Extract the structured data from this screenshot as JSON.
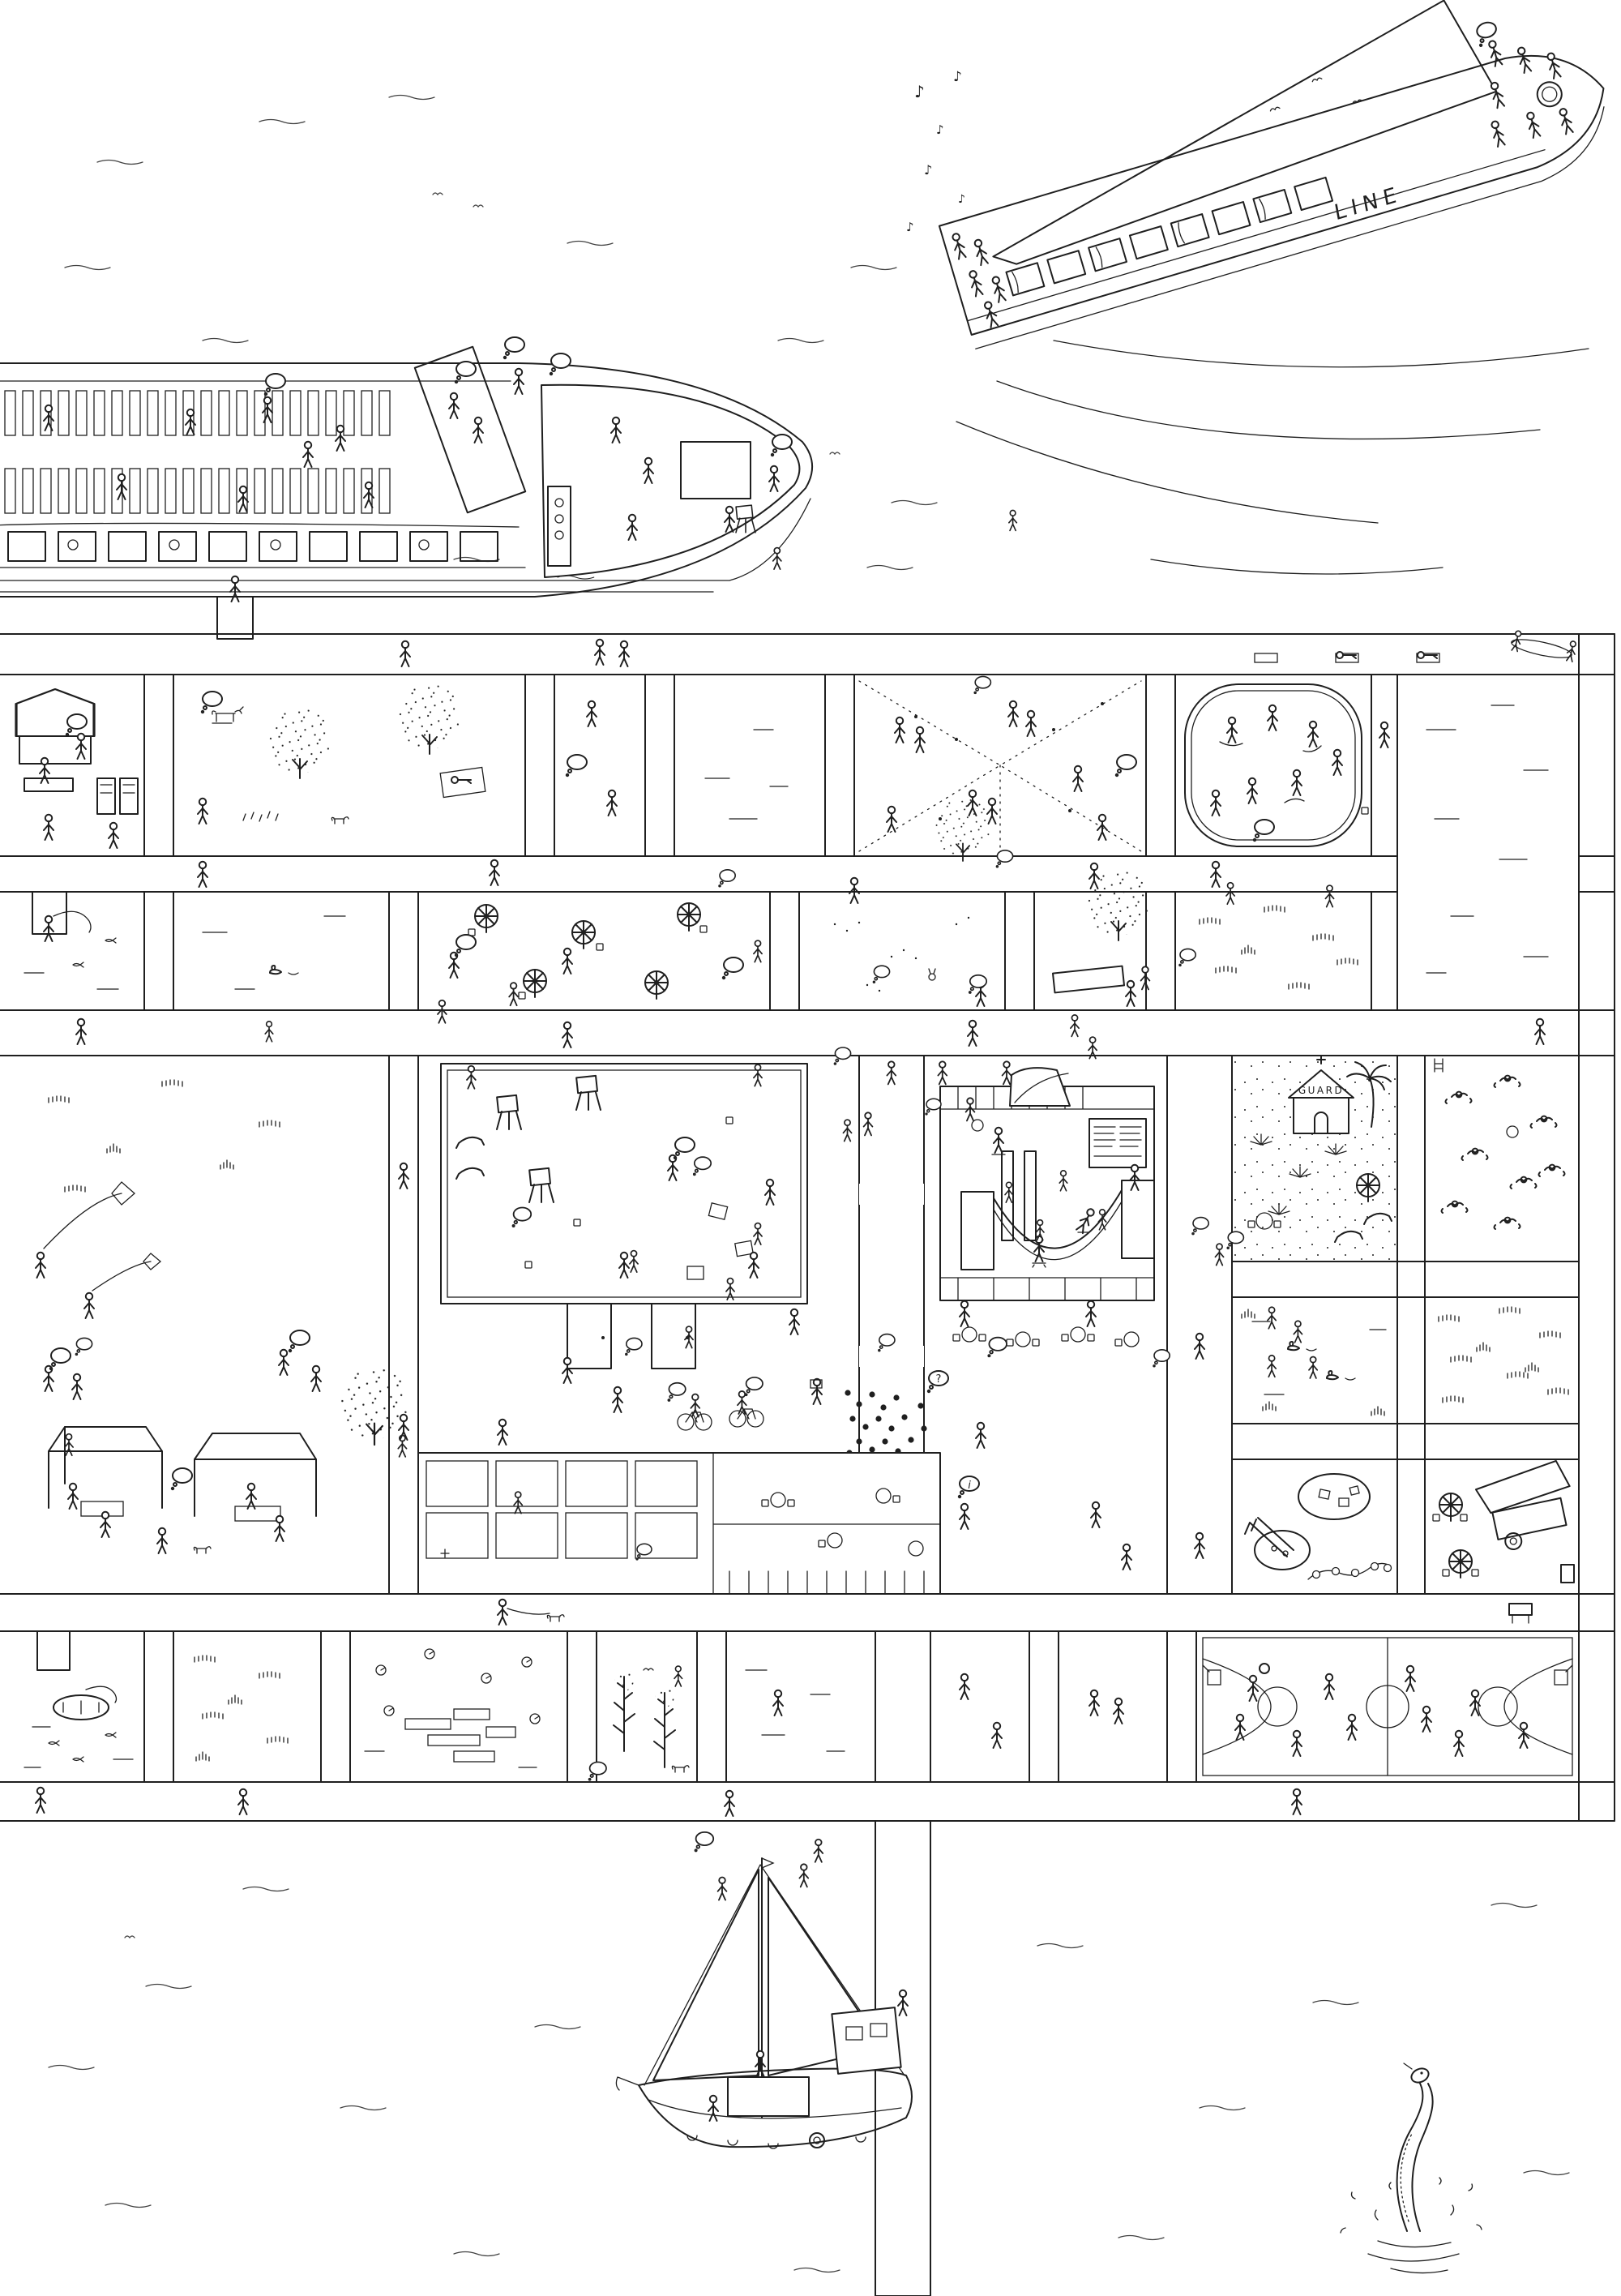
{
  "artwork": {
    "type": "hand-drawn ink illustration",
    "view": "aerial view of a busy public pier city on the water",
    "ink_color": "#1f1f1f",
    "paper_color": "#ffffff"
  },
  "labels": {
    "ferry_hull_text": "LINE",
    "lifeguard_hut_text": "GUARD",
    "music_note": "♪",
    "speech_question": "?",
    "speech_info": "i"
  },
  "vessels": [
    {
      "name": "excursion-ferry",
      "position": "top right",
      "details": "long white canopy roof, dancers on bow deck, band playing music at stern, hull lettered LINE, wake lines behind"
    },
    {
      "name": "tour-boat",
      "position": "top left",
      "details": "rows of deck chairs with sunbathers, striped wheelhouse canopy, planked bow deck, window band with passengers, gangway to the pier"
    },
    {
      "name": "sailboat",
      "position": "bottom center",
      "details": "two raised sails, crew and children on deck, fenders and lifebuoy on hull, moored to the jetty"
    },
    {
      "name": "rowing-dinghy",
      "position": "bottom-left plot",
      "details": "angler fishing from a small boat"
    }
  ],
  "pier": {
    "description": "boardwalk grid of hatched plank walkways framing sunken activity plots",
    "rows": 4,
    "plots": [
      {
        "name": "market-stalls",
        "activity": "hut with striped roof, vendor tables, vending machines, shoppers"
      },
      {
        "name": "tree-park",
        "activity": "stippled trees, cow statue, picnic blanket, flowers, dog"
      },
      {
        "name": "jogging-deck",
        "activity": "planked deck with jogger and travellers"
      },
      {
        "name": "water-plot",
        "activity": "open water with ripples"
      },
      {
        "name": "dance-floor",
        "activity": "criss-cross festoon lights with dancing couples"
      },
      {
        "name": "ice-skating-rink",
        "activity": "rounded rink with skaters and trails"
      },
      {
        "name": "open-water-right",
        "activity": "large water plot along right edge"
      },
      {
        "name": "fishing-pond",
        "activity": "small dock, angler with rod, fish"
      },
      {
        "name": "duck-water",
        "activity": "quiet water with a duck"
      },
      {
        "name": "cafe-terrace",
        "activity": "planked deck with parasol tables"
      },
      {
        "name": "sand-garden",
        "activity": "raked sand, rabbit, child and onlookers"
      },
      {
        "name": "hammock-grove",
        "activity": "trees with striped hammock"
      },
      {
        "name": "dune-grass",
        "activity": "tufted dune grasses"
      },
      {
        "name": "kite-lawn",
        "activity": "kite flyers, climbing tree, barbecue tents"
      },
      {
        "name": "central-plaza",
        "activity": "art class with easels, stairs, gallery hall with notice board, cafe tables, storytime crowd, skate ramps and half-pipe, cyclists, food hall"
      },
      {
        "name": "lifeguard-beach",
        "activity": "sand, GUARD hut with cross, palm tree, agaves, parasol, loungers"
      },
      {
        "name": "swimming-pool",
        "activity": "swimmers, ladder, ball"
      },
      {
        "name": "duck-pond",
        "activity": "ducks and reed tufts"
      },
      {
        "name": "reed-bed",
        "activity": "dense reed tufts"
      },
      {
        "name": "playground",
        "activity": "slide, sand pits with blocks, snake balance beam, children"
      },
      {
        "name": "food-kiosk-court",
        "activity": "awning cart, umbrella tables, recycling bin"
      },
      {
        "name": "rowboat-pond",
        "activity": "dinghy with angler, dock stub, fish"
      },
      {
        "name": "meadow",
        "activity": "grass tufts and strollers"
      },
      {
        "name": "lily-pond",
        "activity": "lily pads and stacked log decks"
      },
      {
        "name": "pine-grove",
        "activity": "tall pines, bird, dog walker"
      },
      {
        "name": "quiet-plot",
        "activity": "sparse marks and walkers"
      },
      {
        "name": "promenade-plot",
        "activity": "strolling figures"
      },
      {
        "name": "strolling-plot",
        "activity": "couple walking"
      },
      {
        "name": "basketball-court",
        "activity": "full court, two hoops, players, ball"
      }
    ],
    "walkway_features": [
      "yoga mats on top walkway",
      "canoe at top-right corner",
      "dog walker",
      "barbecue grill near courts",
      "benches and strollers"
    ]
  },
  "creatures": [
    {
      "name": "sea-serpent",
      "position": "bottom right, rising from the water with splashes"
    },
    {
      "name": "ducks"
    },
    {
      "name": "dog"
    },
    {
      "name": "fish"
    },
    {
      "name": "birds"
    }
  ]
}
